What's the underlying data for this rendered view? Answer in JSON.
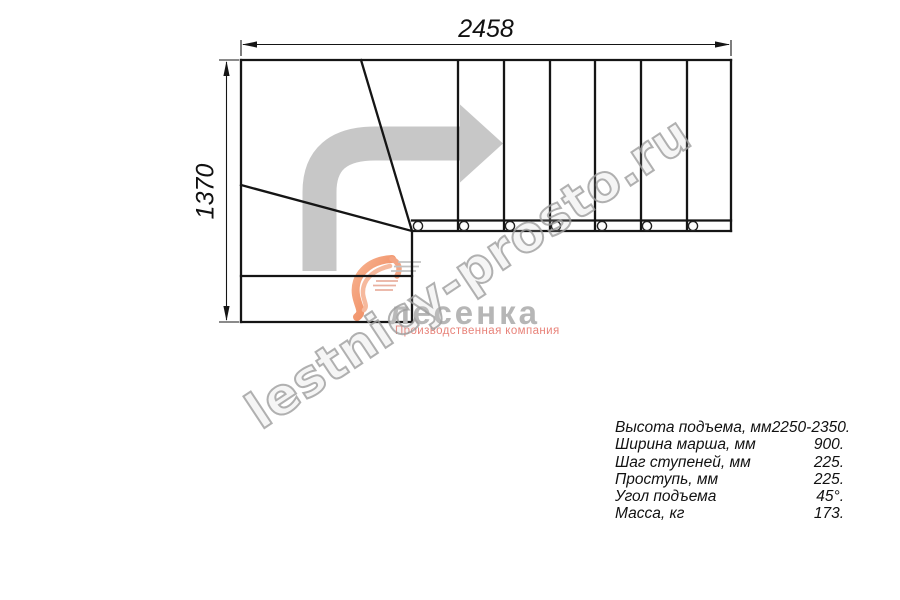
{
  "drawing": {
    "type": "staircase-top-view-plan",
    "top_dimension": "2458",
    "left_dimension": "1370",
    "straight_treads_visible": 7,
    "winder_treads_visible": 3,
    "bolt_circles_visible": 7,
    "direction_arrow": "right-turn-arrow"
  },
  "specs": {
    "rows": [
      {
        "label": "Высота подъема, мм",
        "value": "2250-2350."
      },
      {
        "label": "Ширина марша, мм",
        "value": "900."
      },
      {
        "label": "Шаг ступеней, мм",
        "value": "225."
      },
      {
        "label": "Проступь, мм",
        "value": "225."
      },
      {
        "label": "Угол подъема",
        "value": "45°."
      },
      {
        "label": "Масса, кг",
        "value": "173."
      }
    ]
  },
  "watermark": {
    "text": "lestnicy-prosto.ru",
    "color": "#9e9e9e"
  },
  "logo": {
    "name": "лесенка",
    "tagline": "Производственная компания",
    "mark": "swoosh-bird-icon",
    "orange": "#ee7f52",
    "gray_text": "#b6b6b6",
    "tagline_color": "#e8837a"
  },
  "colors": {
    "line": "#151515",
    "direction_arrow": "#c7c7c7",
    "background": "#ffffff"
  }
}
